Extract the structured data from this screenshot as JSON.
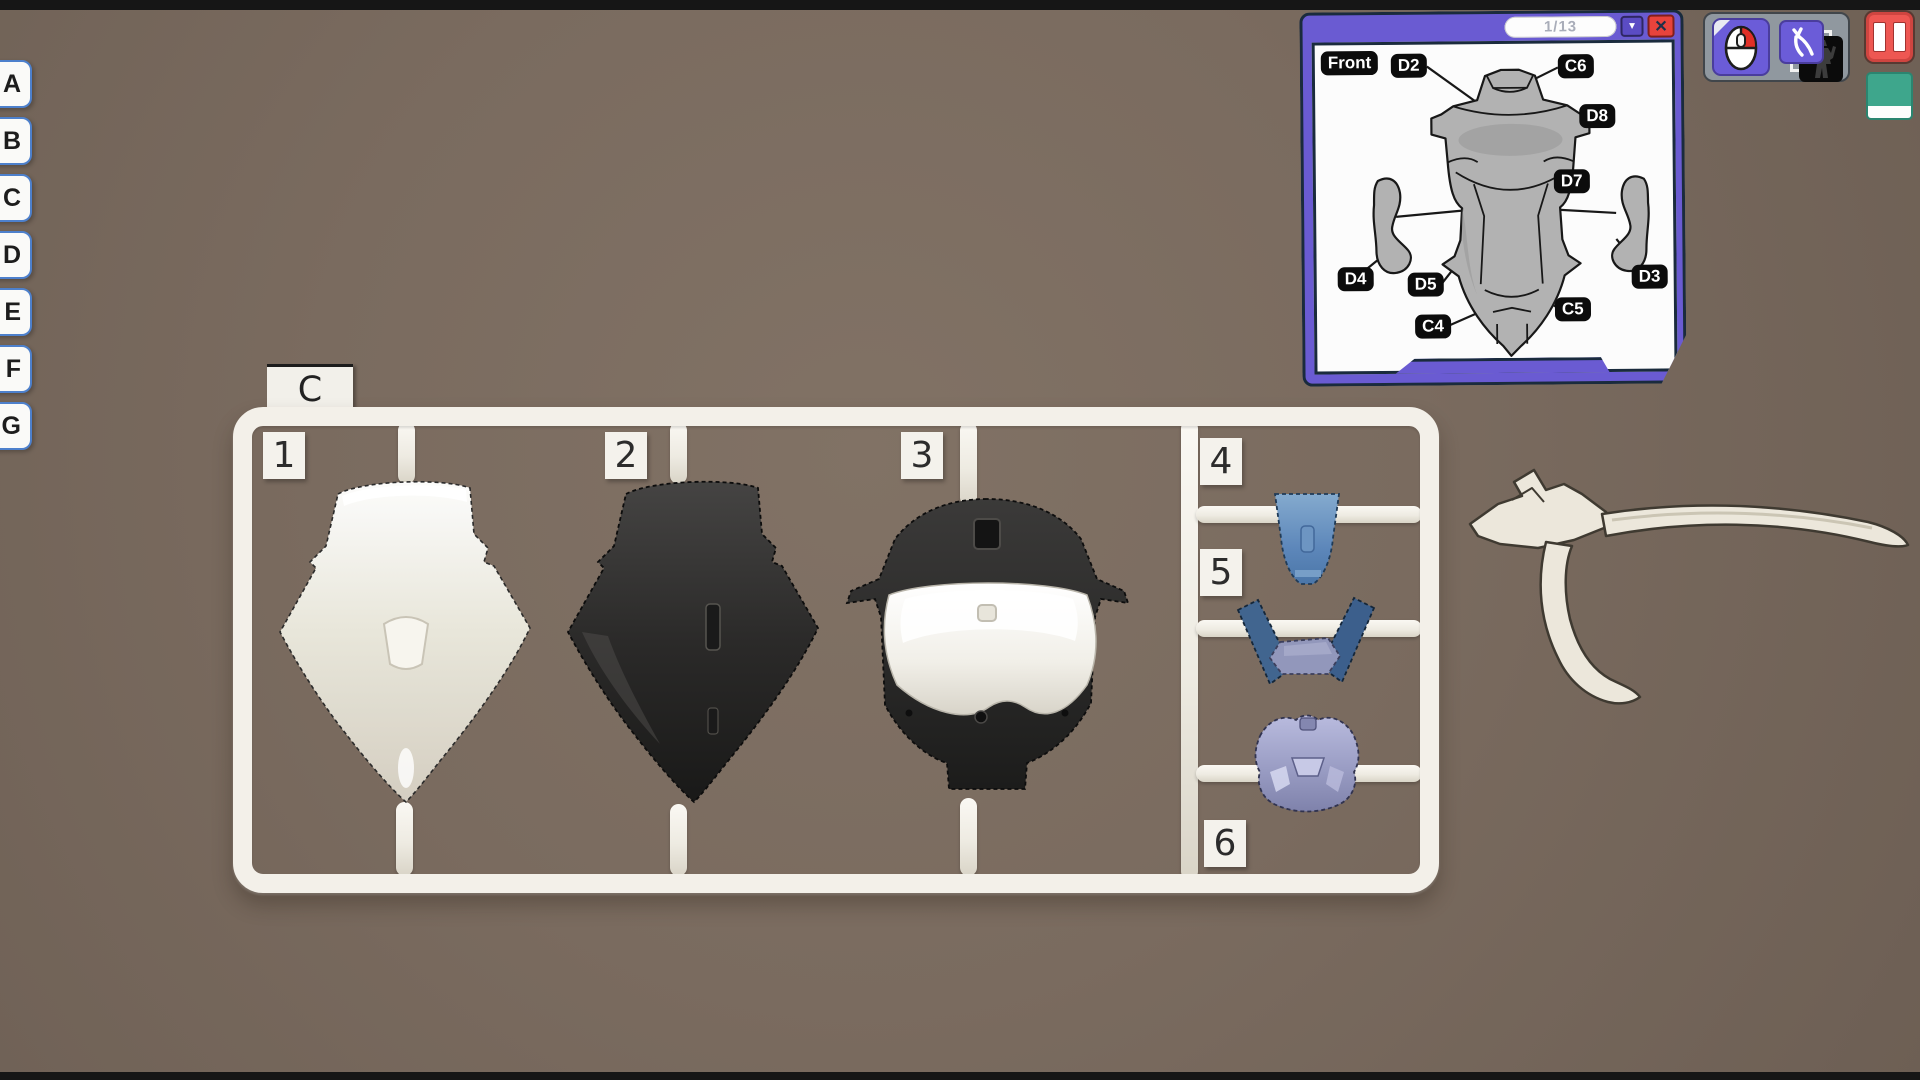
{
  "background": {
    "color": "#7a6b5f",
    "letterbox_color": "#161616"
  },
  "sprue_tabs": {
    "tabs": [
      "A",
      "B",
      "C",
      "D",
      "E",
      "F",
      "G"
    ]
  },
  "sprue": {
    "sheet_label": "C",
    "tags": [
      "1",
      "2",
      "3",
      "4",
      "5",
      "6"
    ],
    "runner_color": "#f3f0e9",
    "part_colors": {
      "part1": "#f2efe9",
      "part2": "#2e2d2c",
      "part3_white": "#f4f2ed",
      "part3_black": "#2a2928",
      "part4": "#5d87ba",
      "part5_strips": "#3d618e",
      "part5_center": "#8f93b8",
      "part6": "#9fa2c9"
    }
  },
  "manual": {
    "page": "1/13",
    "front_label": "Front",
    "labels": {
      "d2": "D2",
      "c6": "C6",
      "d8": "D8",
      "d7": "D7",
      "d4": "D4",
      "d5": "D5",
      "d3": "D3",
      "c4": "C4",
      "c5": "C5"
    },
    "dropdown_glyph": "▼",
    "close_glyph": "✕",
    "frame_color": "#6a5bd2",
    "close_color": "#e8433c"
  },
  "toolbar": {
    "icons": [
      "mouse-icon",
      "nippers-icon",
      "robot-silhouette-icon",
      "pause-icon"
    ],
    "button_color": "#6b5cd8",
    "pause_color": "#ee5752",
    "swatch_color": "#3ea68c"
  }
}
